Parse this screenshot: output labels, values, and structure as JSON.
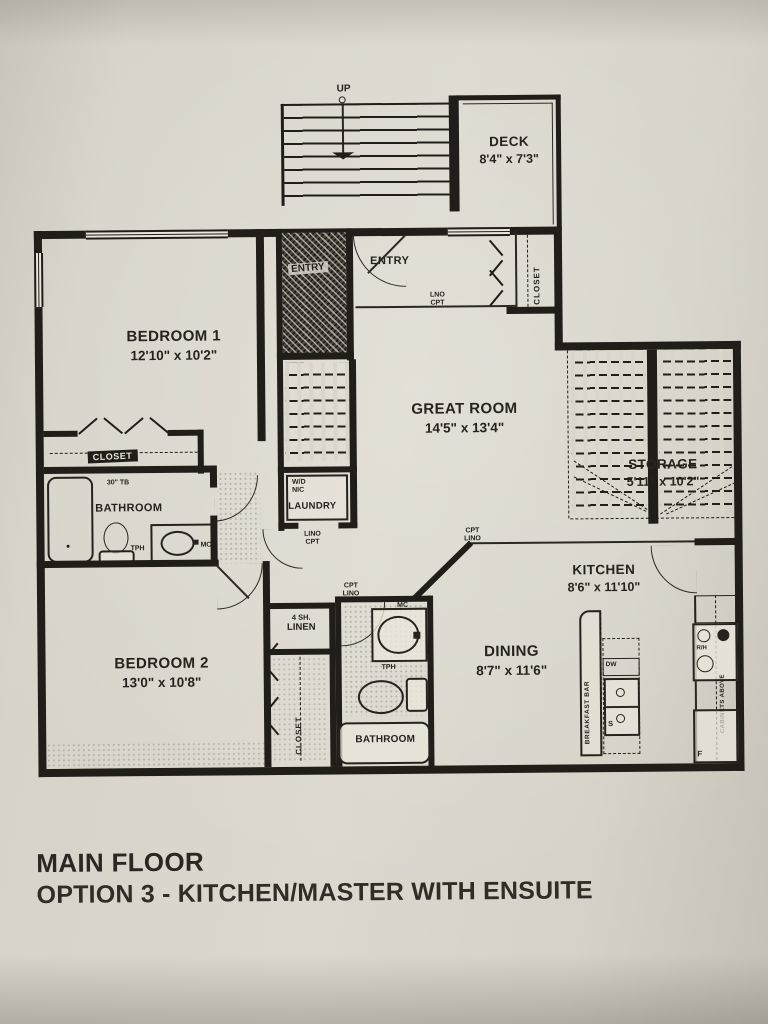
{
  "title_block": {
    "line1": "MAIN FLOOR",
    "line2": "OPTION 3 - KITCHEN/MASTER WITH ENSUITE"
  },
  "rooms": {
    "deck": {
      "name": "DECK",
      "dims": "8'4\" x 7'3\""
    },
    "bedroom1": {
      "name": "BEDROOM 1",
      "dims": "12'10\" x 10'2\""
    },
    "bedroom2": {
      "name": "BEDROOM 2",
      "dims": "13'0\" x 10'8\""
    },
    "great_room": {
      "name": "GREAT ROOM",
      "dims": "14'5\" x 13'4\""
    },
    "storage": {
      "name": "STORAGE",
      "dims": "5'11\" x 10'2\""
    },
    "kitchen": {
      "name": "KITCHEN",
      "dims": "8'6\" x 11'10\""
    },
    "dining": {
      "name": "DINING",
      "dims": "8'7\" x 11'6\""
    },
    "bathroom_main": {
      "name": "BATHROOM"
    },
    "bathroom_ensuite": {
      "name": "BATHROOM"
    },
    "entry_outer": {
      "name": "ENTRY"
    },
    "entry_inner": {
      "name": "ENTRY"
    },
    "laundry": {
      "name": "LAUNDRY"
    }
  },
  "annotations": {
    "up": "UP",
    "closet": "CLOSET",
    "linen_line1": "4 SH.",
    "linen_line2": "LINEN",
    "wd": "W/D",
    "nic": "NIC",
    "lno": "LNO",
    "cpt": "CPT",
    "lino": "LINO",
    "towel_bar": "30\" TB",
    "tph": "TPH",
    "mc": "MC",
    "dw": "DW",
    "sink_s": "S",
    "fridge_f": "F",
    "range_hood": "R/H",
    "breakfast_bar": "BREAKFAST BAR",
    "cabinets_above": "CABINETS ABOVE"
  }
}
